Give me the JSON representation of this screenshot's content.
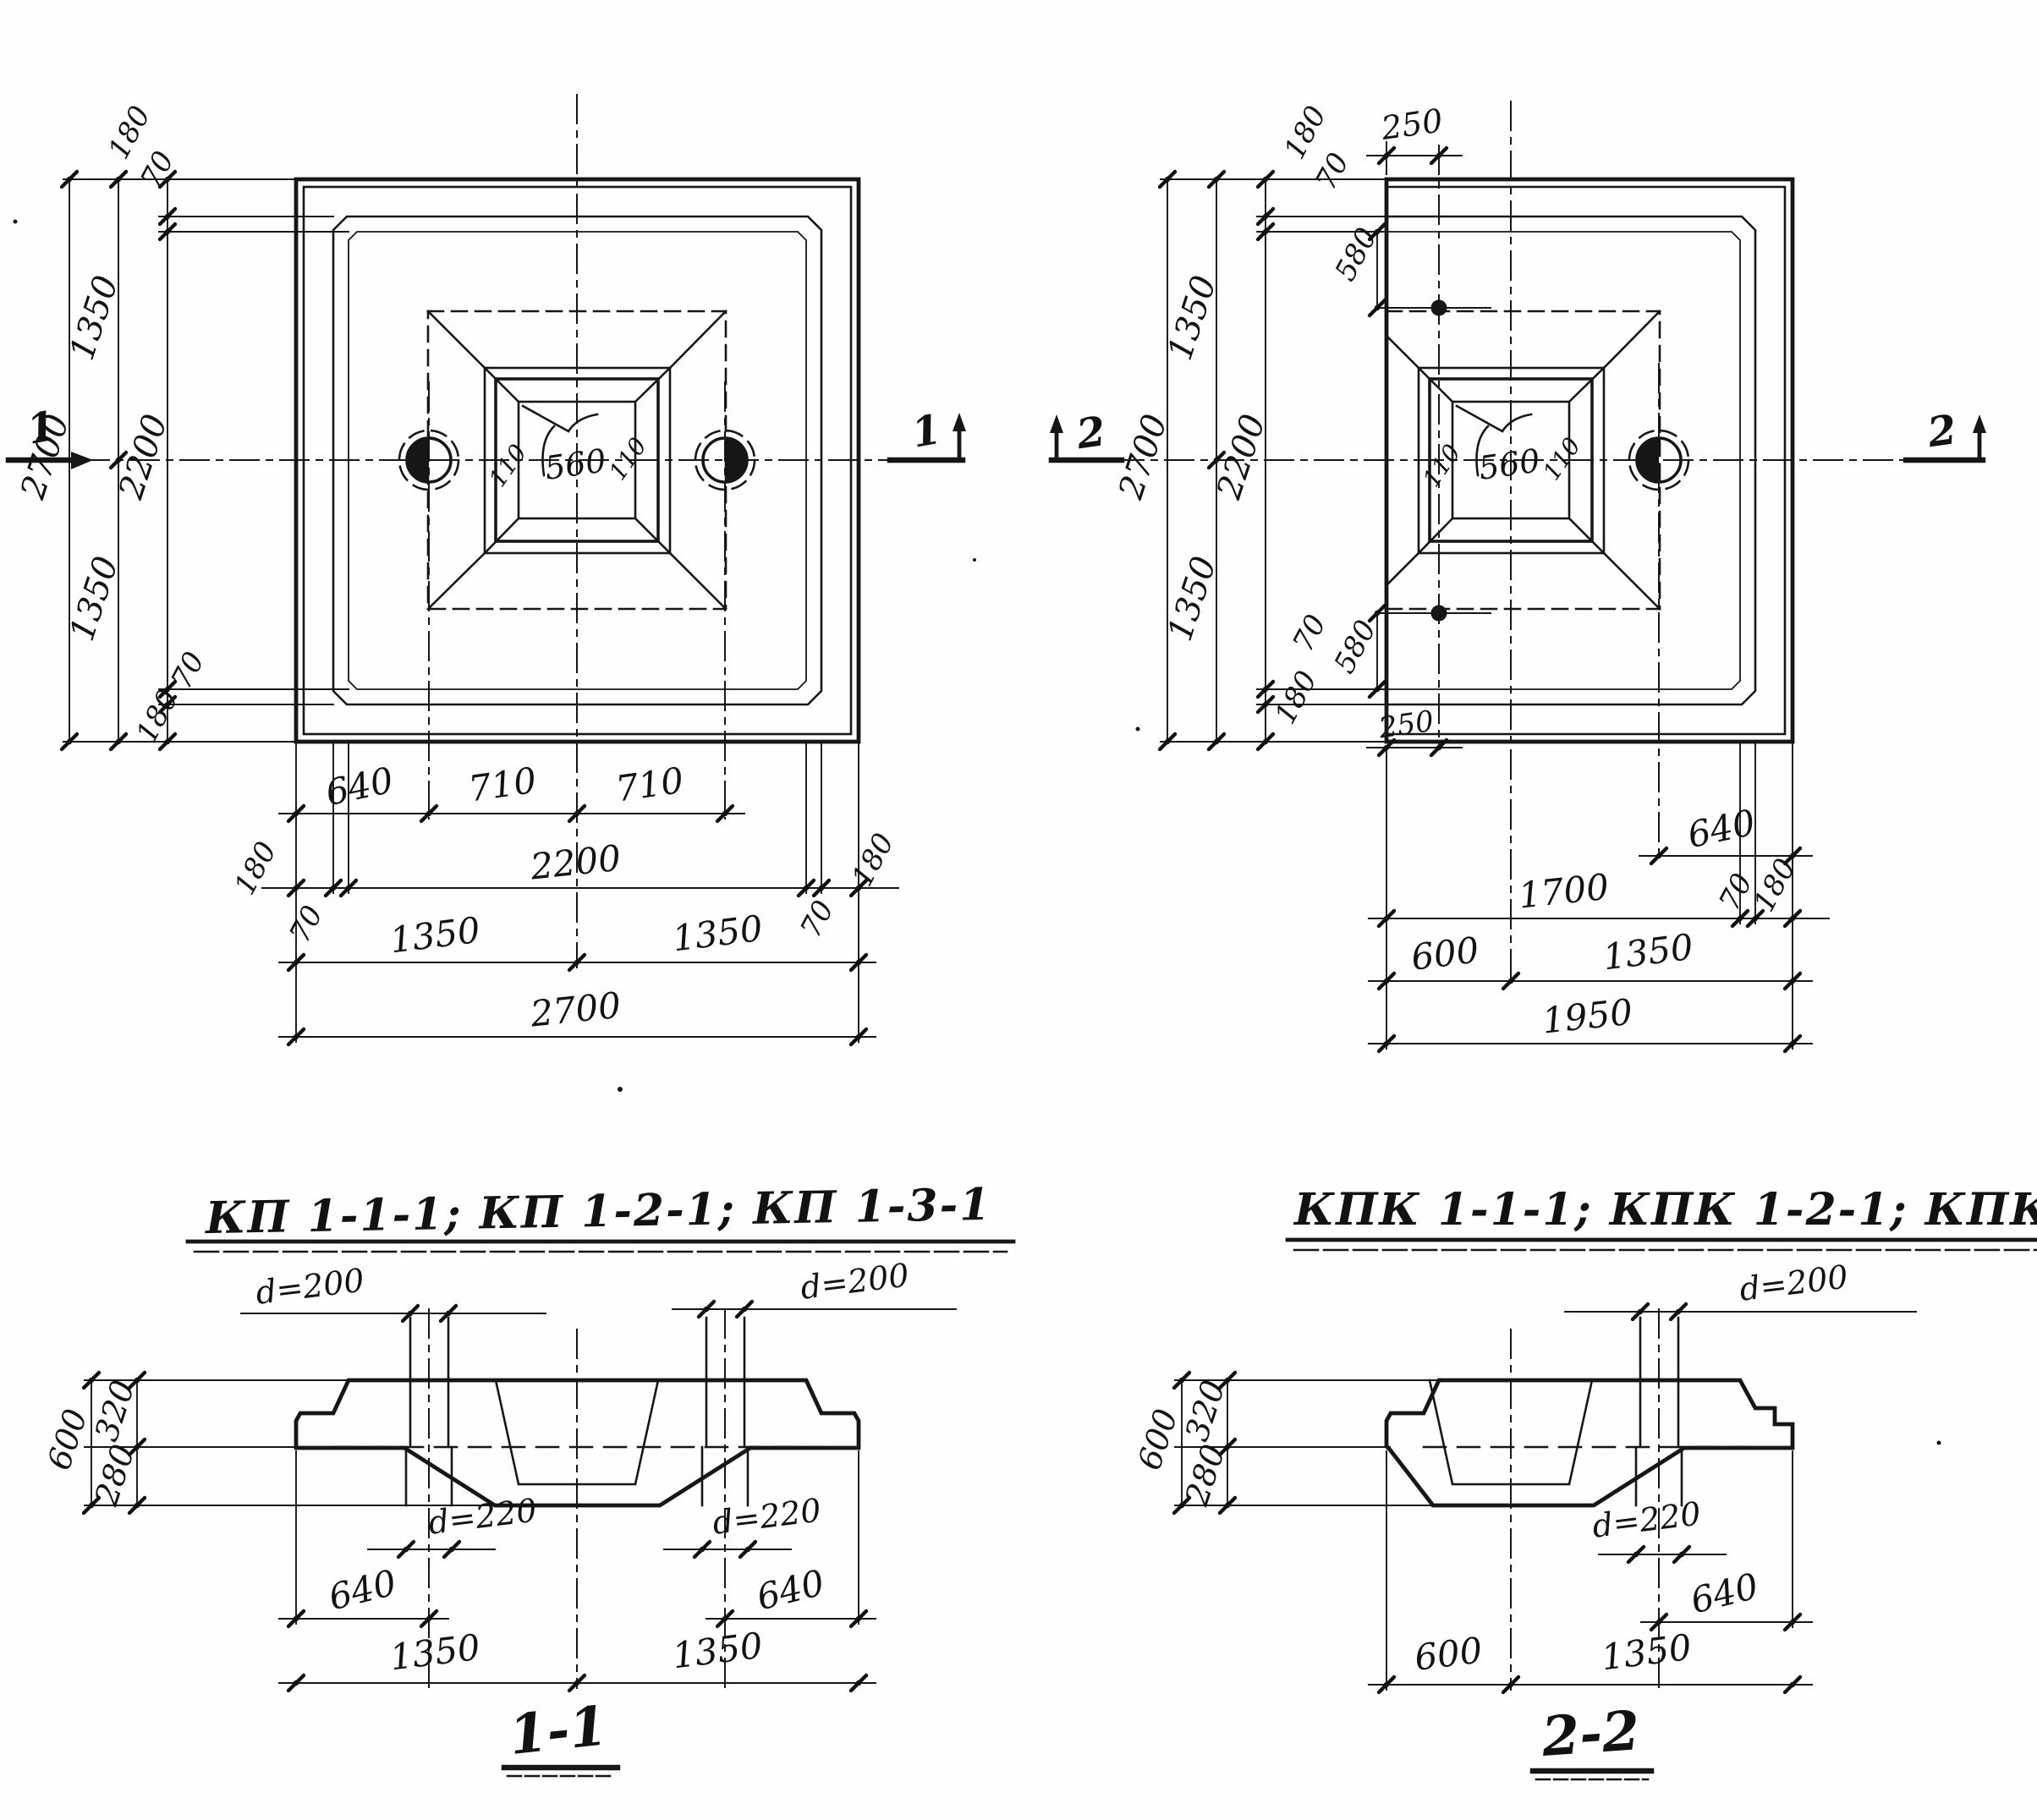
{
  "titles": {
    "left": "КП 1-1-1; КП 1-2-1; КП 1-3-1",
    "right": "КПК 1-1-1; КПК 1-2-1; КПК 1-3-1"
  },
  "plan_left": {
    "marker_left": "1",
    "marker_right": "1",
    "dims": {
      "v_overall": "2700",
      "v_half_top": "1350",
      "v_half_bot": "1350",
      "v_inner": "2200",
      "v_edge_top": "180",
      "v_bevel_top": "70",
      "v_bevel_bot": "70",
      "v_edge_bot": "180",
      "b_640": "640",
      "b_710a": "710",
      "b_710b": "710",
      "b_edge_l": "180",
      "b_inner": "2200",
      "b_edge_r": "180",
      "b_bevel_l": "70",
      "b_bevel_r": "70",
      "b_half_l": "1350",
      "b_half_r": "1350",
      "b_overall": "2700",
      "pocket": "560",
      "wall_l": "110",
      "wall_r": "110"
    }
  },
  "plan_right": {
    "marker_left": "2",
    "marker_right": "2",
    "dims": {
      "v_overall": "2700",
      "v_half_top": "1350",
      "v_half_bot": "1350",
      "v_inner": "2200",
      "v_edge_top": "180",
      "v_bevel_top": "70",
      "v_loop_top": "580",
      "v_edge_bot": "180",
      "v_bevel_bot": "70",
      "v_loop_bot": "580",
      "t_250": "250",
      "b_250": "250",
      "b_640": "640",
      "b_1700": "1700",
      "b_bevel": "70",
      "b_edge": "180",
      "b_600": "600",
      "b_1350": "1350",
      "b_overall": "1950",
      "pocket": "560",
      "wall_l": "110",
      "wall_r": "110"
    }
  },
  "section_1": {
    "label": "1-1",
    "dims": {
      "total": "600",
      "upper": "320",
      "lower": "280",
      "d_top_l": "d=200",
      "d_top_r": "d=200",
      "d_bot_l": "d=220",
      "d_bot_r": "d=220",
      "off_l": "640",
      "off_r": "640",
      "half_l": "1350",
      "half_r": "1350"
    }
  },
  "section_2": {
    "label": "2-2",
    "dims": {
      "total": "600",
      "upper": "320",
      "lower": "280",
      "d_top": "d=200",
      "d_bot": "d=220",
      "off": "640",
      "left": "600",
      "right": "1350"
    }
  }
}
